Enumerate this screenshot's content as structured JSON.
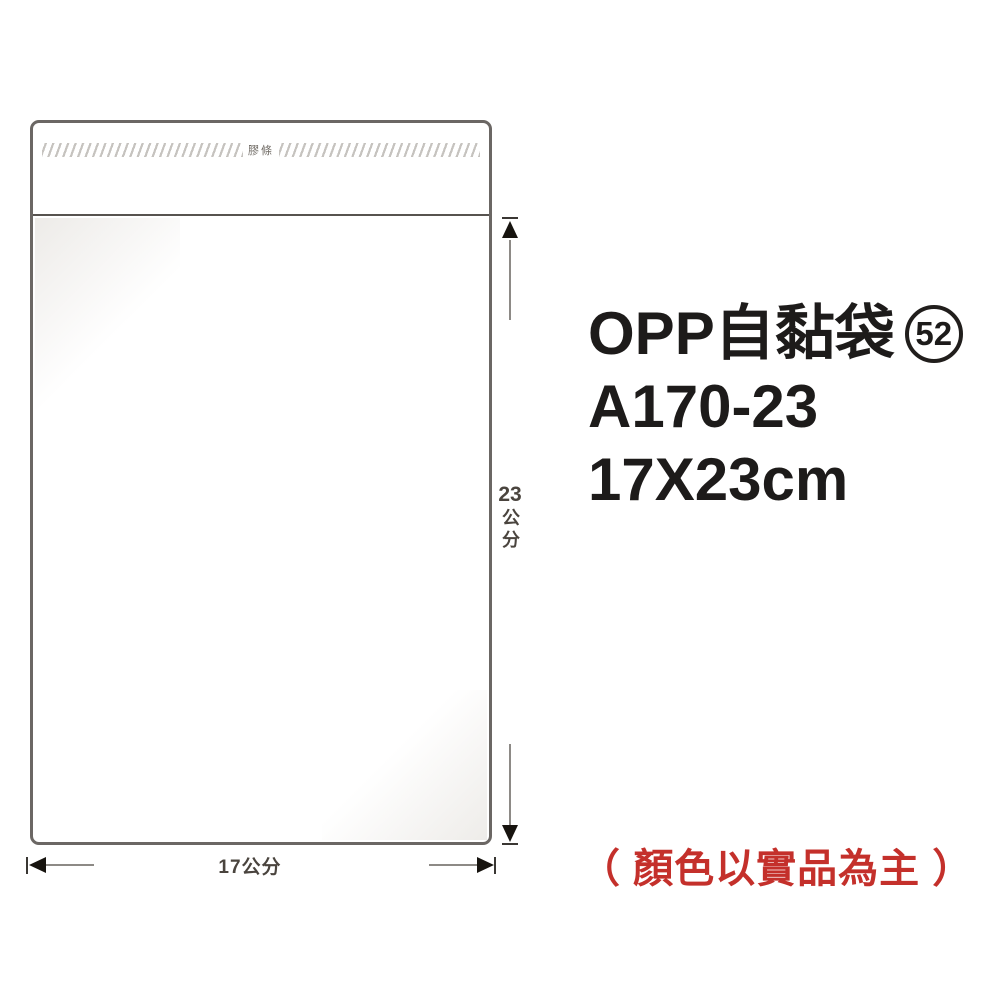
{
  "product": {
    "name": "OPP自黏袋",
    "badge_number": "52",
    "model": "A170-23",
    "size": "17X23cm",
    "color_note": "（ 顏色以實品為主 ）"
  },
  "diagram": {
    "adhesive_strip_label": "膠條",
    "height": {
      "value": "23",
      "unit": "公分"
    },
    "width_label": "17公分"
  },
  "colors": {
    "note_red": "#c4302b",
    "text_black": "#1d1b1a",
    "bag_outline": "#6b6764",
    "dimension_text": "#4a443e"
  }
}
